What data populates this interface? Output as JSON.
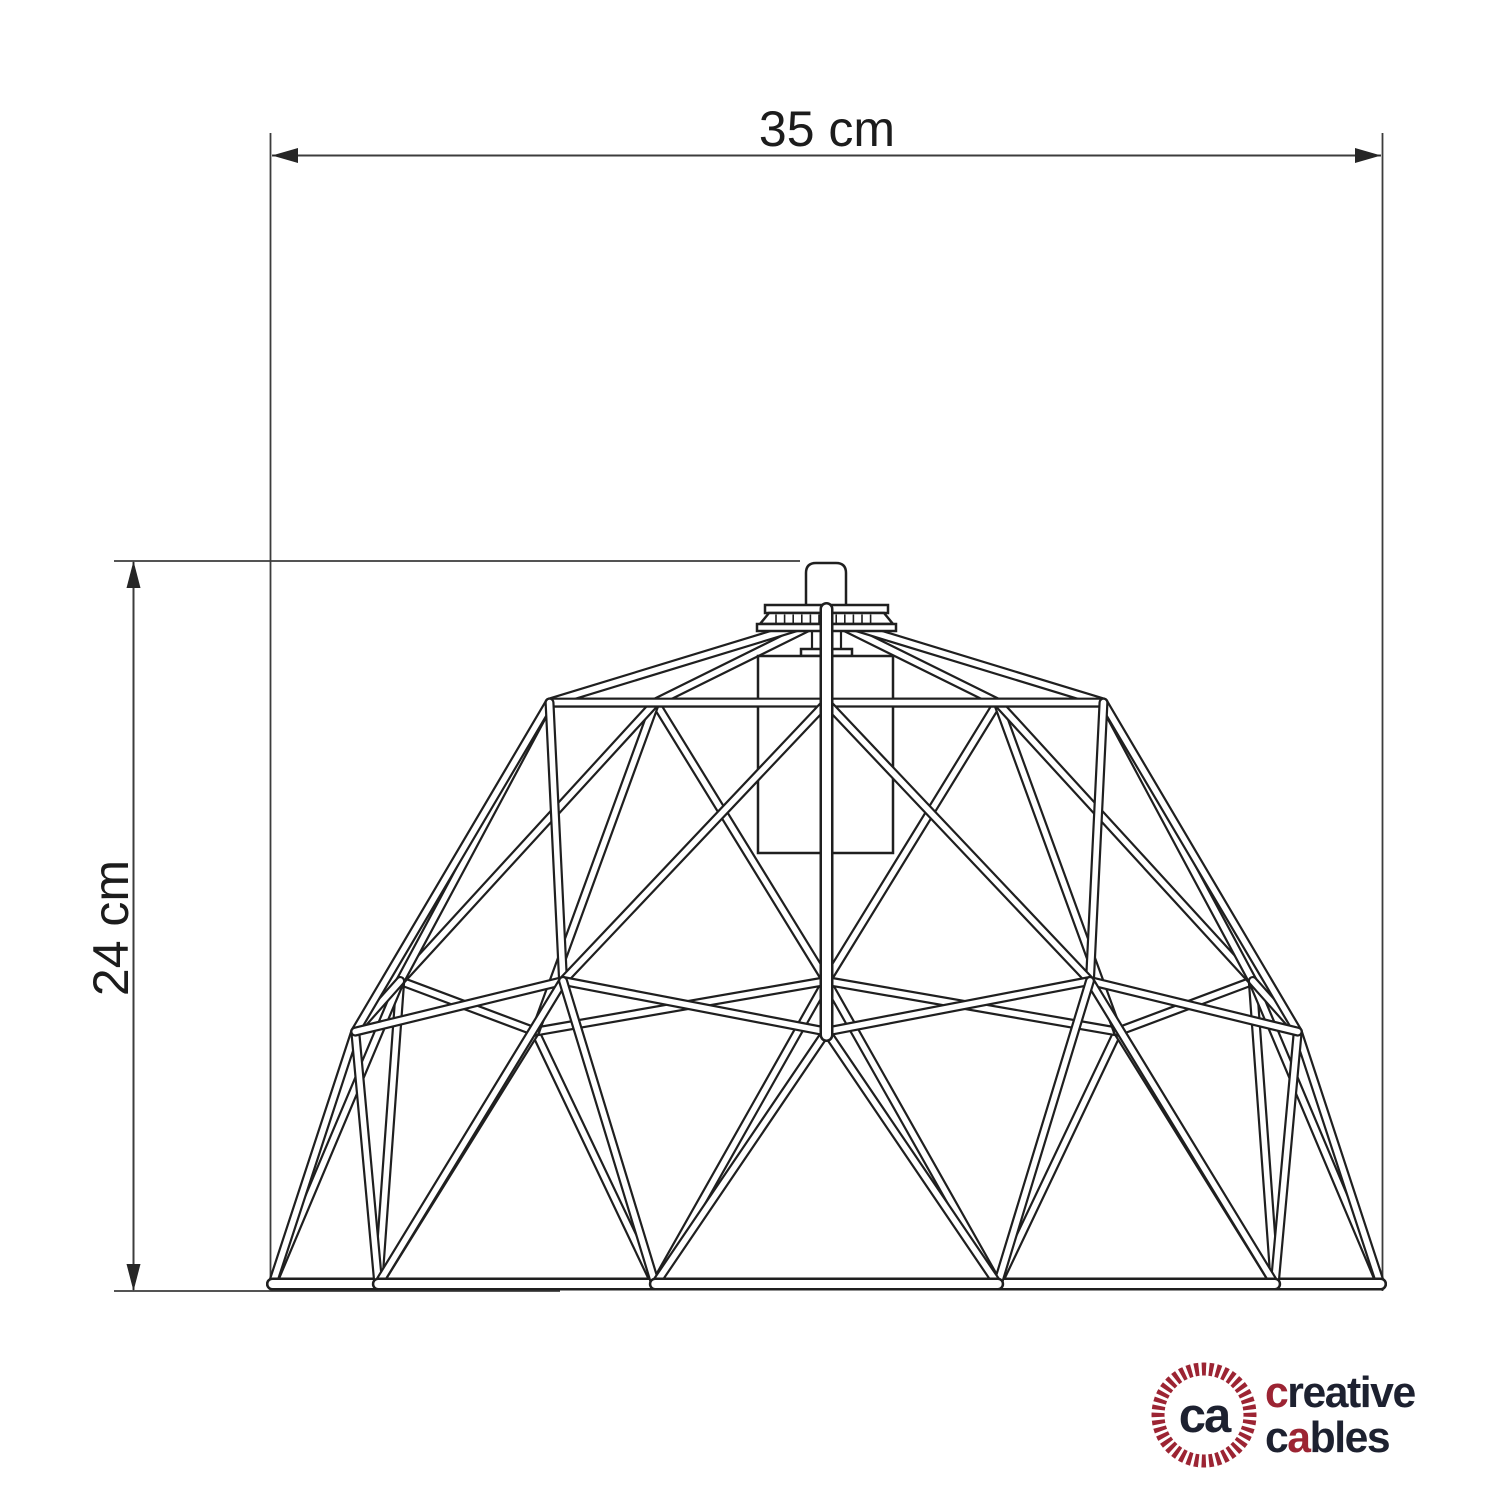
{
  "page": {
    "background": "#ffffff"
  },
  "dimensions": {
    "width": {
      "label": "35 cm",
      "value": 35,
      "unit": "cm"
    },
    "height": {
      "label": "24 cm",
      "value": 24,
      "unit": "cm"
    }
  },
  "logo": {
    "monogram": "ca",
    "word1_parts": [
      "c",
      "reative"
    ],
    "word2_parts": [
      "c",
      "a",
      "bles"
    ],
    "colors": {
      "red": "#9c2433",
      "dark": "#1d2130"
    }
  },
  "style": {
    "stroke_dark": "#1f1f1f",
    "dimension_color": "#3c3c3c",
    "arrow_fill": "#262626"
  }
}
